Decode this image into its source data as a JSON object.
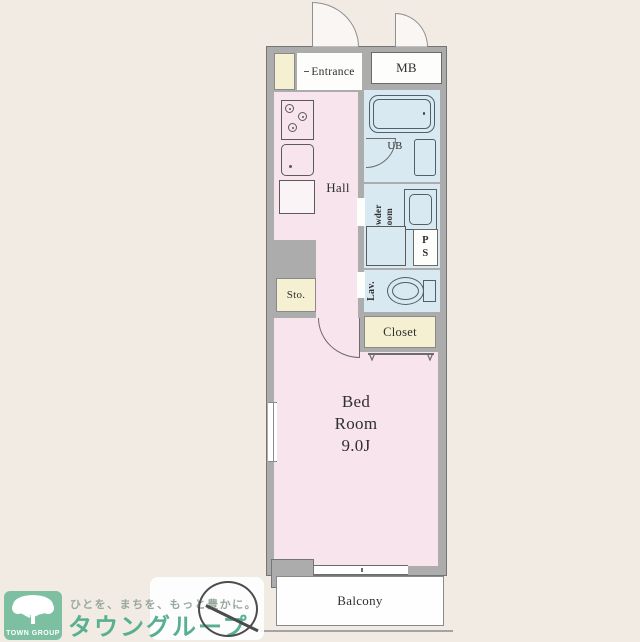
{
  "page": {
    "background": "#f1ebe4"
  },
  "plan": {
    "colors": {
      "wall": "#acacac",
      "wall_line": "#757575",
      "room_pink": "#f8e4ed",
      "room_blue": "#d9e9f1",
      "room_cream": "#f6f0d2",
      "room_white": "#fdfdfb"
    },
    "rooms": {
      "entrance": {
        "label": "Entrance"
      },
      "mb": {
        "label": "MB"
      },
      "hall": {
        "label": "Hall"
      },
      "bath": {
        "label": "UB"
      },
      "powder": {
        "line1": "Powder",
        "line2": "Room"
      },
      "ps": {
        "line1": "P",
        "line2": "S"
      },
      "storage": {
        "label": "Sto."
      },
      "lavatory": {
        "label": "Lav."
      },
      "closet": {
        "label": "Closet"
      },
      "bedroom": {
        "line1": "Bed",
        "line2": "Room",
        "line3": "9.0J"
      },
      "balcony": {
        "label": "Balcony"
      }
    }
  },
  "logo": {
    "square_color": "#7cc0a1",
    "group_label": "TOWN GROUP",
    "tagline": "ひとを、まちを、もっと豊かに。",
    "brand": "タウングループ",
    "brand_color": "#58b091",
    "tagline_color": "#98a89e"
  }
}
